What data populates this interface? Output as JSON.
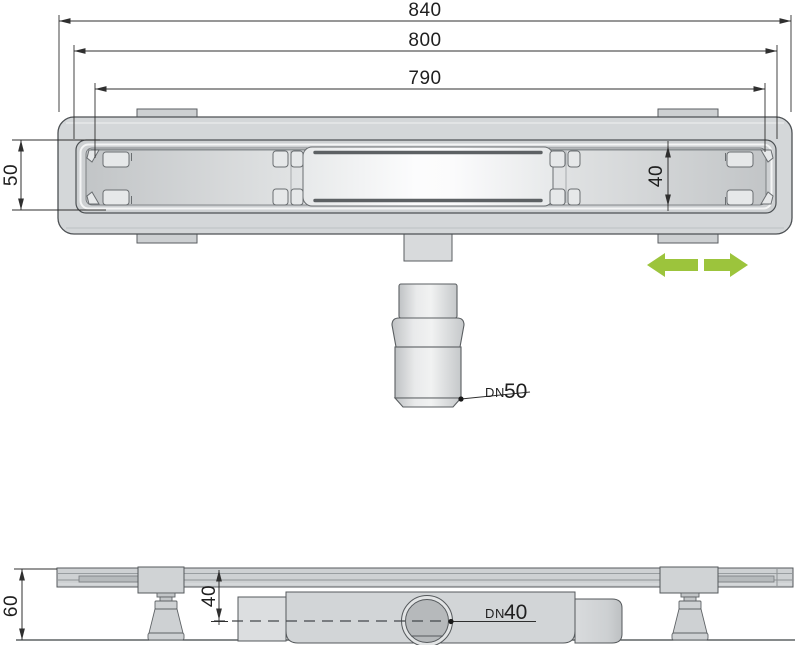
{
  "drawing": {
    "top_view": {
      "dim_total_width": "840",
      "dim_flange_width": "800",
      "dim_grate_width": "790",
      "dim_channel_height": "50",
      "dim_grate_height": "40",
      "outlet_label_prefix": "DN",
      "outlet_label_size": "50"
    },
    "side_view": {
      "dim_total_height": "60",
      "dim_outlet_axis_depth": "40",
      "outlet_label_prefix": "DN",
      "outlet_label_size": "40"
    },
    "colors": {
      "accent_green": "#9cc43c",
      "line": "#2f2f2f",
      "body_gray": "#d4d7d9"
    }
  }
}
